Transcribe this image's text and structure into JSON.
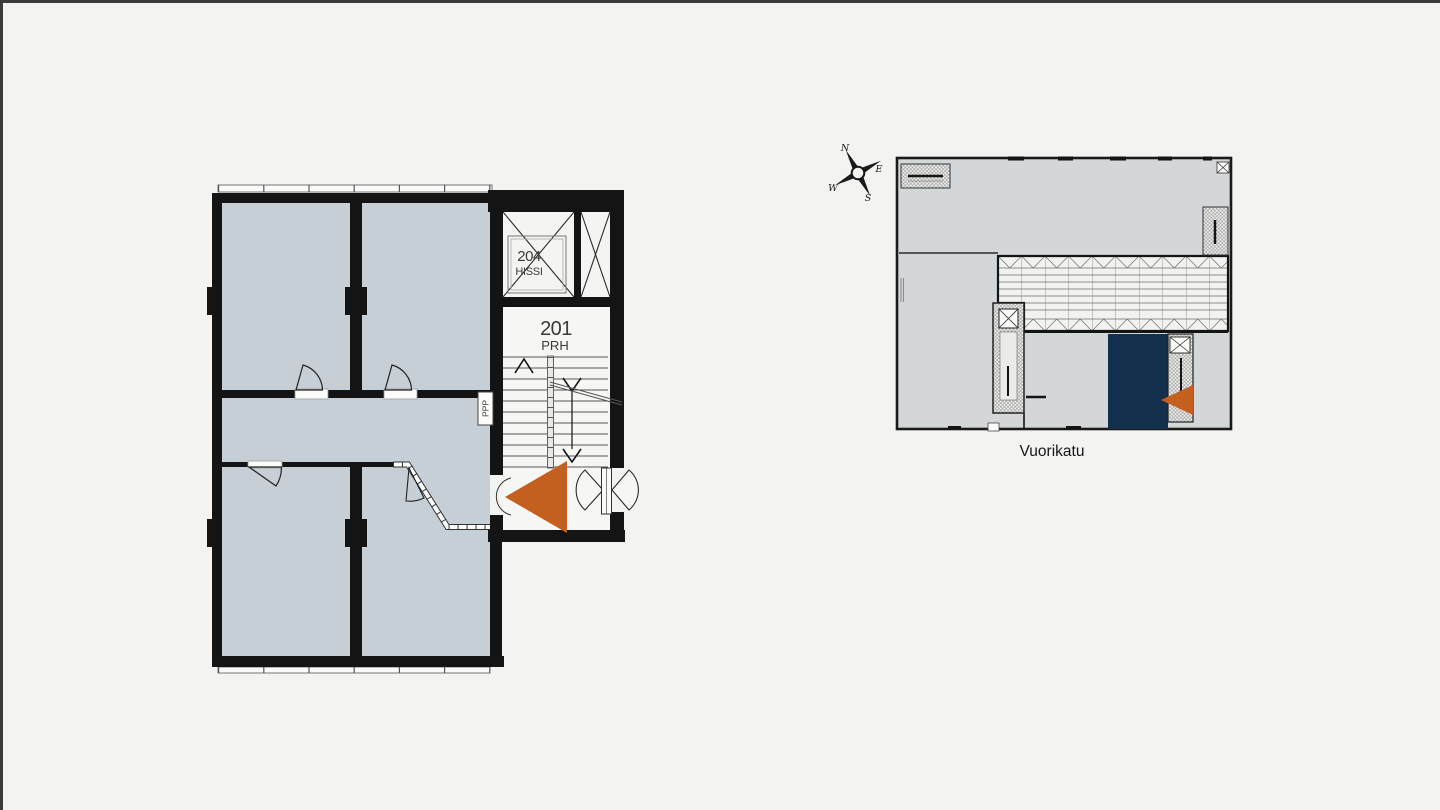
{
  "page": {
    "background": "#f3f3f2",
    "frame_border_color": "#3a3a3a"
  },
  "floor_plan": {
    "elevator": {
      "number": "204",
      "name": "HISSI"
    },
    "stairwell": {
      "number": "201",
      "name": "PRH"
    },
    "shaft_label": "PPP",
    "colors": {
      "room_fill": "#c7cfd6",
      "wall": "#141414",
      "marker": "#c4601f"
    }
  },
  "overview": {
    "street": "Vuorikatu",
    "compass": {
      "north": "N",
      "east": "E",
      "south": "S",
      "west": "W"
    },
    "colors": {
      "building_fill": "#d4d7d9",
      "highlight": "#122f4c",
      "marker": "#c4601f"
    }
  }
}
